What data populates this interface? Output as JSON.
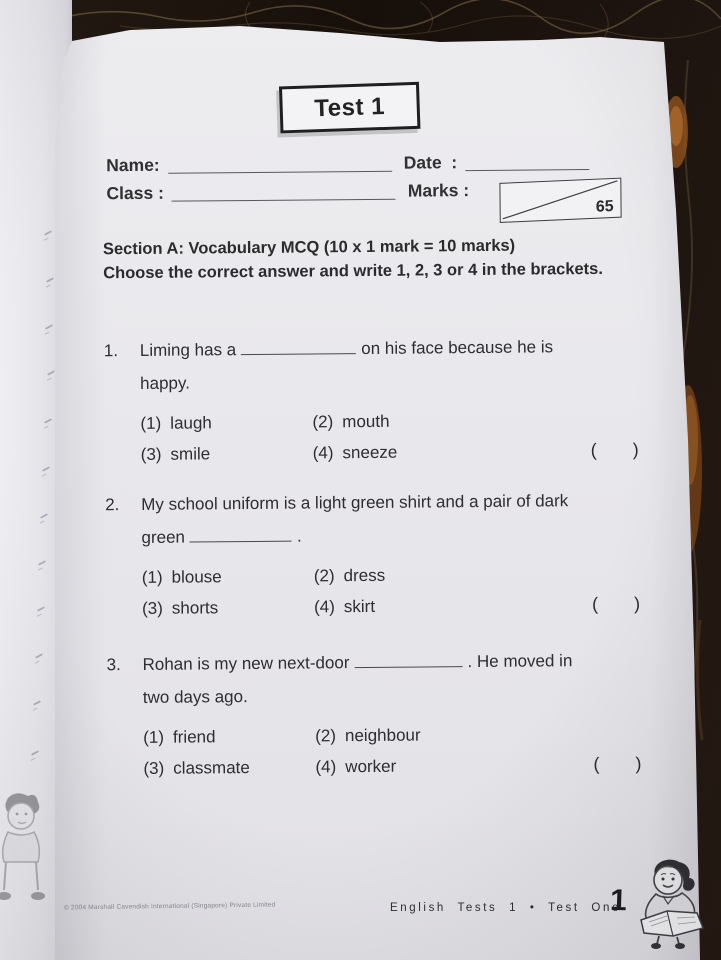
{
  "colors": {
    "ink": "#2e2e31",
    "page": "#eaeaee",
    "marble_dark": "#1c130d",
    "marble_vein": "#97835c",
    "marble_amber": "#a55d20",
    "rule_line": "#47474d"
  },
  "test": {
    "title": "Test 1"
  },
  "fields": {
    "name_label": "Name:",
    "class_label": "Class :",
    "date_label": "Date  :",
    "marks_label": "Marks :",
    "marks_total": "65"
  },
  "section": {
    "heading": "Section A: Vocabulary MCQ (10 x 1 mark = 10 marks)",
    "instructions": "Choose the correct answer and write 1, 2, 3 or 4 in the brackets."
  },
  "brackets": {
    "open": "(",
    "close": ")"
  },
  "questions": [
    {
      "number": "1.",
      "line1_pre": "Liming has a",
      "line1_post": "on his face because he is",
      "line2": "happy.",
      "options": [
        {
          "num": "(1)",
          "label": "laugh"
        },
        {
          "num": "(2)",
          "label": "mouth"
        },
        {
          "num": "(3)",
          "label": "smile"
        },
        {
          "num": "(4)",
          "label": "sneeze"
        }
      ]
    },
    {
      "number": "2.",
      "line1": "My school uniform is a light green shirt and a pair of dark",
      "line2_pre": "green",
      "line2_post": ".",
      "options": [
        {
          "num": "(1)",
          "label": "blouse"
        },
        {
          "num": "(2)",
          "label": "dress"
        },
        {
          "num": "(3)",
          "label": "shorts"
        },
        {
          "num": "(4)",
          "label": "skirt"
        }
      ]
    },
    {
      "number": "3.",
      "line1_pre": "Rohan is my new next-door",
      "line1_post": ". He moved in",
      "line2": "two days ago.",
      "options": [
        {
          "num": "(1)",
          "label": "friend"
        },
        {
          "num": "(2)",
          "label": "neighbour"
        },
        {
          "num": "(3)",
          "label": "classmate"
        },
        {
          "num": "(4)",
          "label": "worker"
        }
      ]
    }
  ],
  "footer": {
    "copyright": "© 2004 Marshall Cavendish International (Singapore) Private Limited",
    "running_title": "English Tests 1 • Test One",
    "page_number": "1"
  },
  "illustrations": {
    "bottom_right": "girl-reading",
    "bottom_left": "child-figure-faint"
  }
}
